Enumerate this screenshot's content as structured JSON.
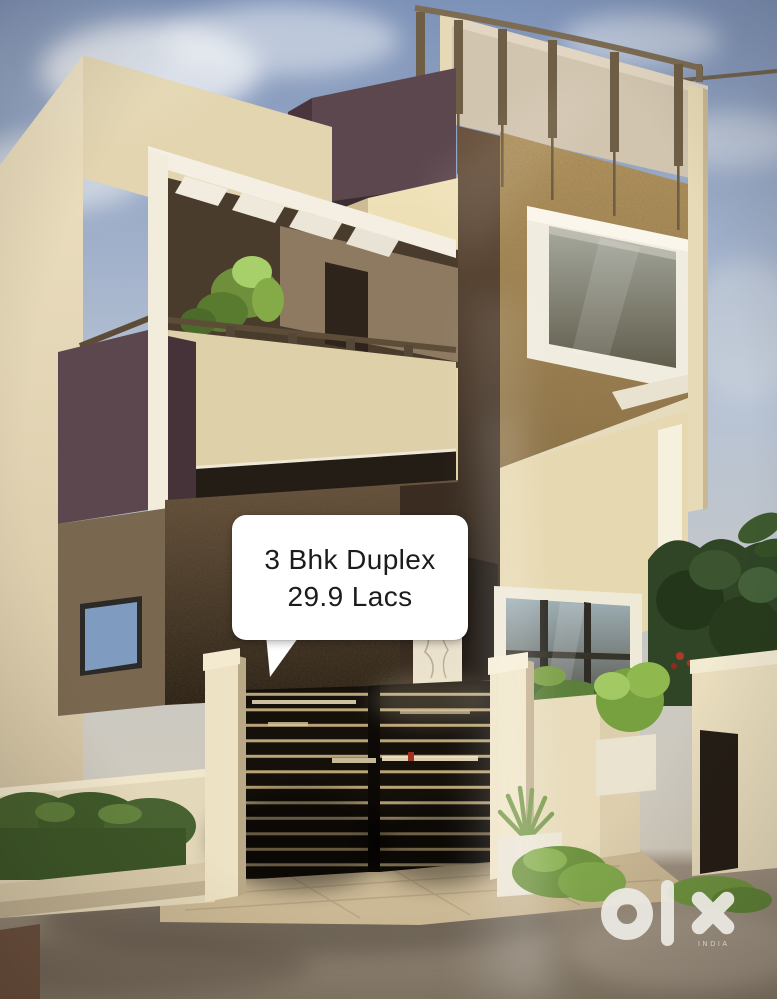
{
  "photo": {
    "caption_bubble": {
      "line1": "3 Bhk Duplex",
      "line2": "29.9 Lacs"
    },
    "watermark": {
      "brand": "olx",
      "country": "INDIA"
    }
  },
  "colors": {
    "sky_top": "#7d92b8",
    "sky_haze": "#d6cbb9",
    "wall_cream": "#e9dcb5",
    "wall_shade": "#cdbb94",
    "accent_maroon": "#5d474e",
    "texture_tan": "#ab8a58",
    "gate_dark": "#15100a",
    "foliage_dark": "#2f4526",
    "foliage_bright": "#7fa24b",
    "ground": "#978b7c",
    "bubble_bg": "#ffffff",
    "bubble_text": "#1c1c1c",
    "watermark_white": "#eceae3"
  }
}
